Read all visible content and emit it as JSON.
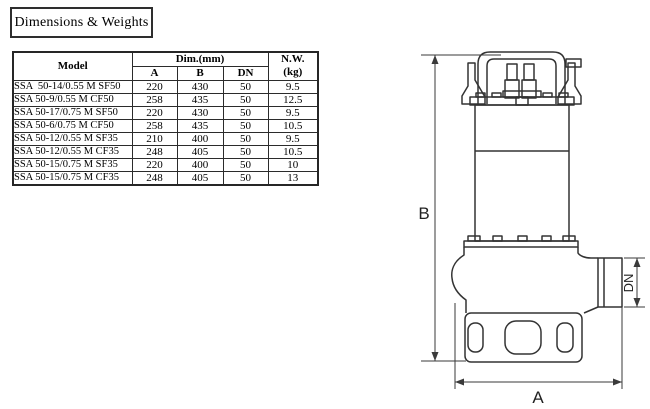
{
  "title_box": {
    "label": "Dimensions & Weights"
  },
  "table": {
    "header": {
      "model": "Model",
      "dim": "Dim.(mm)",
      "a": "A",
      "b": "B",
      "dn": "DN",
      "nw_line1": "N.W.",
      "nw_line2": "(kg)"
    },
    "rows": [
      {
        "model": "SSA  50-14/0.55 M SF50",
        "a": "220",
        "b": "430",
        "dn": "50",
        "nw": "9.5"
      },
      {
        "model": "SSA 50-9/0.55 M CF50",
        "a": "258",
        "b": "435",
        "dn": "50",
        "nw": "12.5"
      },
      {
        "model": "SSA 50-17/0.75 M SF50",
        "a": "220",
        "b": "430",
        "dn": "50",
        "nw": "9.5"
      },
      {
        "model": "SSA 50-6/0.75 M CF50",
        "a": "258",
        "b": "435",
        "dn": "50",
        "nw": "10.5"
      },
      {
        "model": "SSA 50-12/0.55 M SF35",
        "a": "210",
        "b": "400",
        "dn": "50",
        "nw": "9.5"
      },
      {
        "model": "SSA 50-12/0.55 M CF35",
        "a": "248",
        "b": "405",
        "dn": "50",
        "nw": "10.5"
      },
      {
        "model": "SSA 50-15/0.75 M SF35",
        "a": "220",
        "b": "400",
        "dn": "50",
        "nw": "10"
      },
      {
        "model": "SSA 50-15/0.75 M CF35",
        "a": "248",
        "b": "405",
        "dn": "50",
        "nw": "13"
      }
    ]
  },
  "drawing": {
    "labels": {
      "a": "A",
      "b": "B",
      "dn": "DN"
    },
    "line_color": "#333333"
  },
  "colors": {
    "background": "#ffffff",
    "text": "#000000",
    "border": "#2b2b2b"
  }
}
